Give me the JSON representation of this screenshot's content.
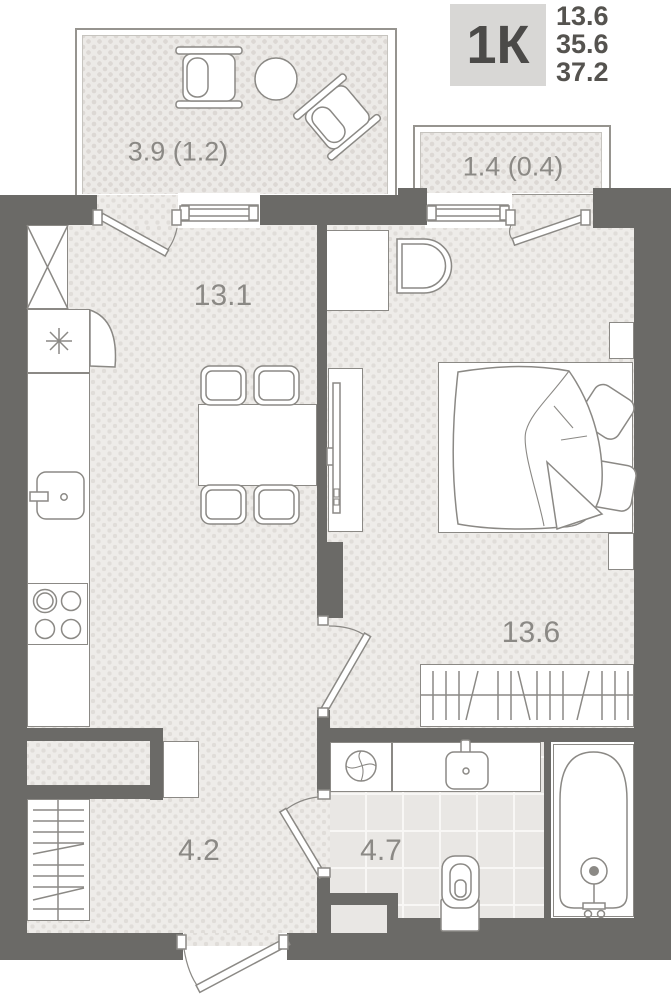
{
  "header": {
    "plan_type": "1К",
    "area_values": [
      "13.6",
      "35.6",
      "37.2"
    ]
  },
  "room_labels": {
    "living_kitchen": "13.1",
    "bedroom": "13.6",
    "hallway": "4.2",
    "bathroom": "4.7",
    "balcony_left": "3.9 (1.2)",
    "balcony_right": "1.4 (0.4)"
  },
  "icons": [
    "window-icon",
    "door-swing-icon",
    "entrance-door-icon",
    "bed-icon",
    "pillow-icon",
    "bathtub-icon",
    "toilet-icon",
    "sink-icon",
    "washing-machine-icon",
    "stove-icon",
    "fridge-snowflake-icon",
    "wardrobe-x-icon",
    "hanger-wardrobe-icon",
    "dining-table-icon",
    "chair-icon",
    "tv-icon",
    "armchair-icon",
    "round-table-icon",
    "crib-icon",
    "nightstand-icon"
  ],
  "colors": {
    "wall": "#6b6a67",
    "furniture_outline": "#8b8985",
    "floor": "#eeece9",
    "floor_dot": "#e0ddd9",
    "balcony_floor": "#eceae7",
    "tile_floor": "#e9e7e4",
    "tile_line": "#f8f7f5",
    "header_box_bg": "#d8d7d5",
    "header_text": "#4b4a48",
    "label_text": "#8b8985"
  }
}
